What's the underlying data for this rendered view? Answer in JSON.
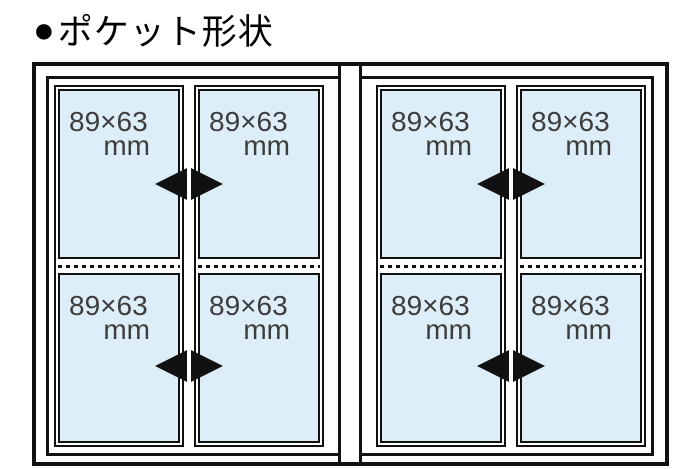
{
  "title": {
    "bullet": "●",
    "text": "ポケット形状"
  },
  "diagram": {
    "pockets": [
      {
        "size": "89×63",
        "unit": "mm"
      },
      {
        "size": "89×63",
        "unit": "mm"
      },
      {
        "size": "89×63",
        "unit": "mm"
      },
      {
        "size": "89×63",
        "unit": "mm"
      },
      {
        "size": "89×63",
        "unit": "mm"
      },
      {
        "size": "89×63",
        "unit": "mm"
      },
      {
        "size": "89×63",
        "unit": "mm"
      },
      {
        "size": "89×63",
        "unit": "mm"
      }
    ],
    "icons": {
      "bullet": "filled-circle",
      "insert_direction": "left-right-solid-triangles",
      "fold_line": "horizontal-dotted-line"
    },
    "colors": {
      "pocket_fill": "#ddeef9",
      "line": "#111111",
      "label_text": "#3d3d3d"
    }
  }
}
